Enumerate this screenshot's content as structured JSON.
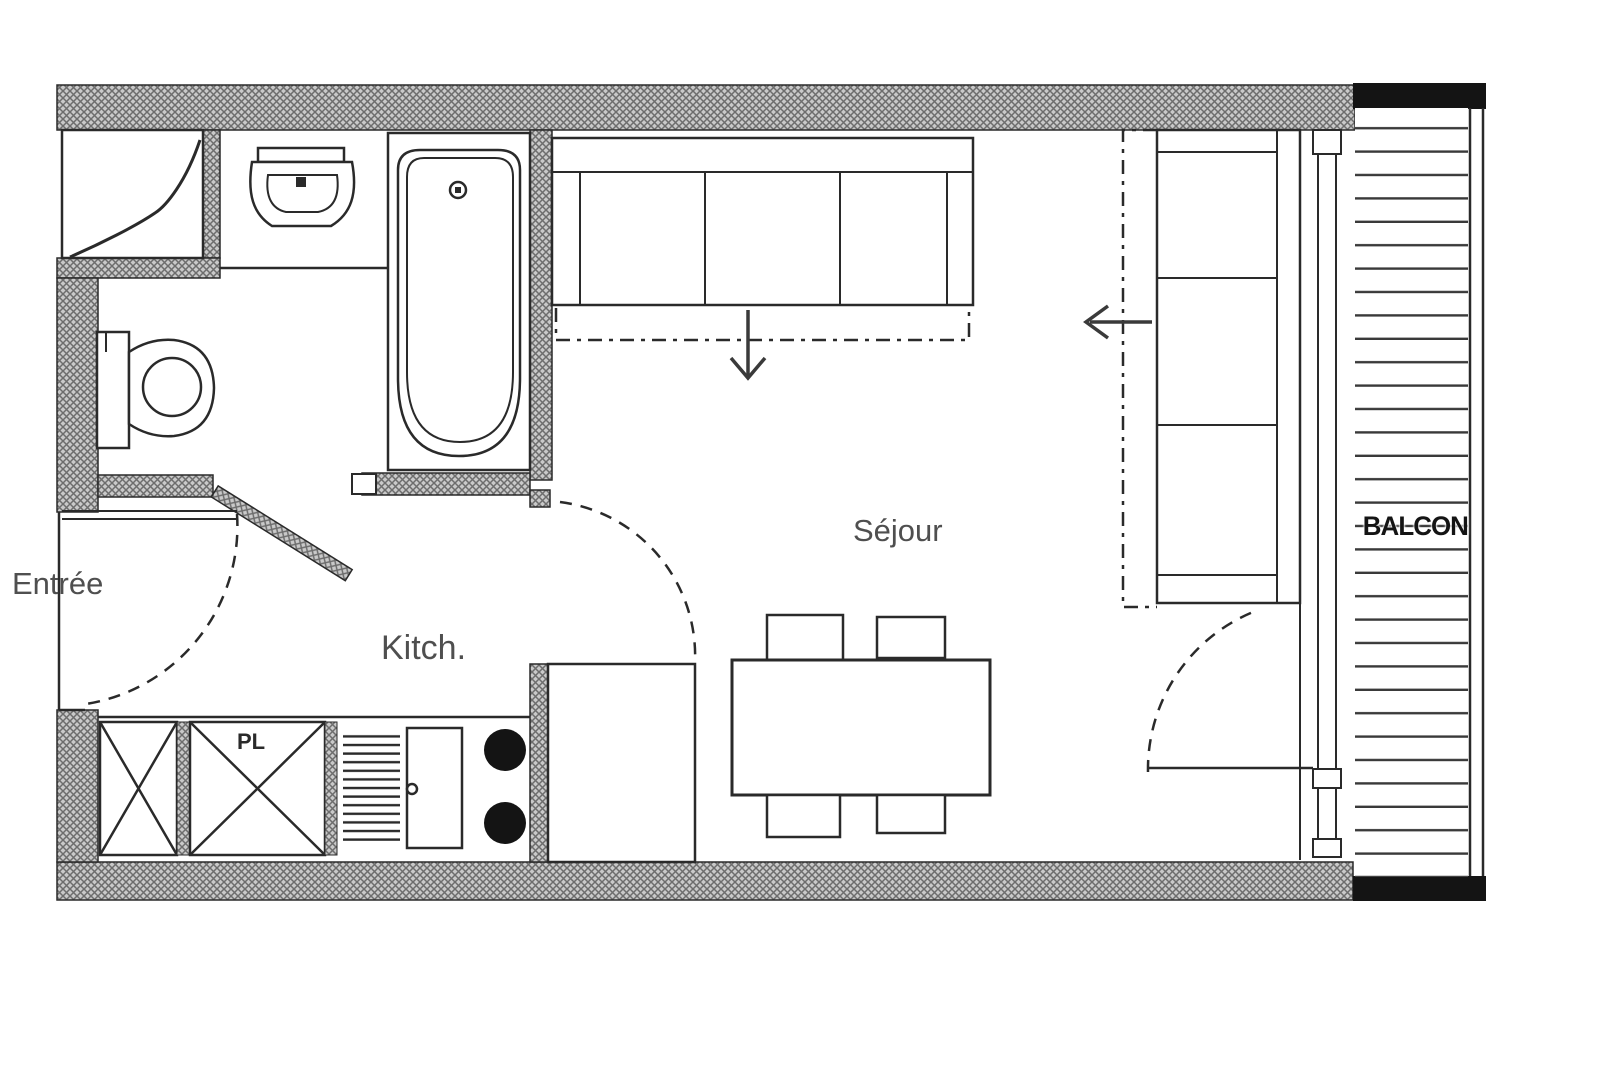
{
  "plan": {
    "type": "apartment-floor-plan",
    "labels": {
      "entree": "Entrée",
      "kitchen": "Kitch.",
      "living": "Séjour",
      "balcony": "BALCON",
      "closet": "PL"
    },
    "colors": {
      "background": "#ffffff",
      "line": "#2a2a2a",
      "wall_hatch_base": "#c9c9c9",
      "wall_hatch_line": "#6d6d6d",
      "solid_black": "#141414",
      "label_gray": "#4f4f4f"
    },
    "fixtures": [
      "closet-curtain-icon",
      "washbasin-icon",
      "bathtub-icon",
      "toilet-icon",
      "sofa-bed-top-icon",
      "sofa-bed-right-icon",
      "fold-out-arrow-down-icon",
      "fold-out-arrow-left-icon",
      "dining-table-icon",
      "chair-icon",
      "appliance-cross-box-icon",
      "kitchen-rack-icon",
      "kitchen-cabinet-door-icon",
      "hob-burner-icon",
      "door-swing-arc-icon",
      "window-icon",
      "balcony-decking-icon",
      "balcony-railing-icon"
    ]
  }
}
